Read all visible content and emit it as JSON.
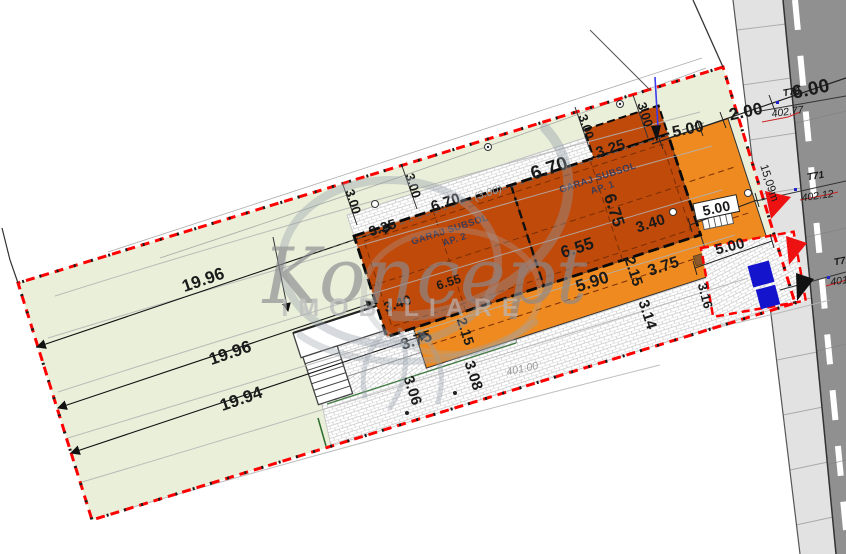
{
  "colors": {
    "boundary_red": "#ff0000",
    "building_dark_orange": "#c04a0a",
    "building_light_orange": "#ee8a1f",
    "plot_green": "#e9efd9",
    "road_gray": "#909090",
    "sidewalk_gray": "#e2e2e2",
    "parking_marker_blue": "#1414cc",
    "survey_id_blue": "#2323cc",
    "survey_elev_red": "#cc2222",
    "wall_brown": "#8b5a2b",
    "watermark_gray": "#8e99a6"
  },
  "watermark": {
    "brand": "Koncept",
    "subtitle": "IMOBILIARE"
  },
  "building": {
    "garage1_line1": "GARAJ SUBSOL",
    "garage1_line2": "AP. 1",
    "garage2_line1": "GARAJ SUBSOL",
    "garage2_line2": "AP. 2"
  },
  "plot_widths": {
    "w1": "19.96",
    "w2": "19.96",
    "w3": "19.94"
  },
  "dims": {
    "len_top_left": "6.70",
    "len_top_left_note": "(3.00)",
    "len_top": "6.70",
    "w_left": "3.25",
    "w_right": "3.25",
    "depth_right": "6.75",
    "len_mid": "6.55",
    "len_mid_b": "6.55",
    "r340": "3.40",
    "r375": "3.75",
    "r215": "2.15",
    "len_bottom": "5.90",
    "l340": "3.40",
    "l375": "3.75",
    "l215": "2.15",
    "s314": "3.14",
    "s316": "3.16",
    "s308": "3.08",
    "s306": "3.06",
    "level": "401.00",
    "off1": "3.00",
    "off2": "3.00",
    "off3": "3.00",
    "off4": "3.00",
    "front_setback": "5.00",
    "gate": "5.00",
    "access": "5.00",
    "sidewalk": "2.00",
    "road": "6.00",
    "frontage": "15,09m"
  },
  "survey": {
    "t70": {
      "id": "T70",
      "elev": "402.77"
    },
    "t71": {
      "id": "T71",
      "elev": "402.12"
    },
    "t72": {
      "id": "T72",
      "elev": "401."
    }
  }
}
